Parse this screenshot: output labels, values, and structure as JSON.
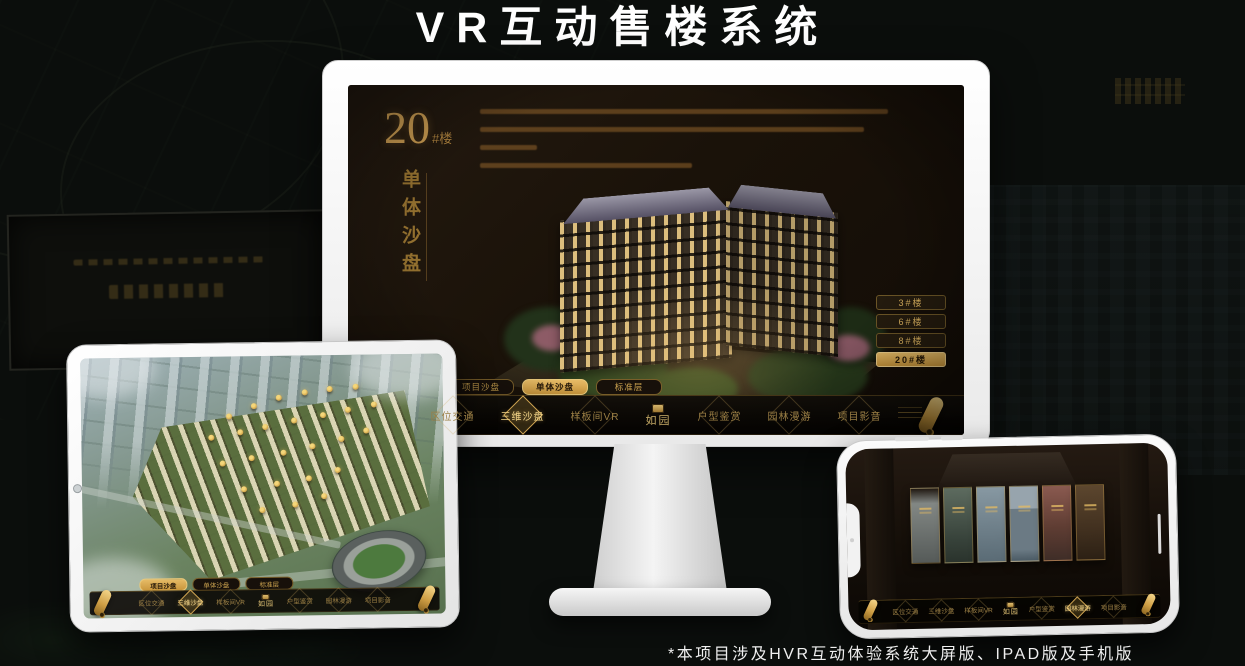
{
  "page": {
    "title": "VR互动售楼系统",
    "footnote": "*本项目涉及HVR互动体验系统大屏版、IPAD版及手机版"
  },
  "colors": {
    "gold": "#d2a855",
    "gold_bright": "#f2d488",
    "screen_background": "#1a1209",
    "selected_tab_fill": "#d8aa55",
    "title_text": "#ffffff"
  },
  "monitor_app": {
    "heading": {
      "number": "20",
      "suffix": "#楼",
      "vertical_label": "单体沙盘"
    },
    "building_buttons": [
      {
        "label": "3#楼",
        "selected": false
      },
      {
        "label": "6#楼",
        "selected": false
      },
      {
        "label": "8#楼",
        "selected": false
      },
      {
        "label": "20#楼",
        "selected": true
      }
    ],
    "sub_tabs": [
      {
        "label": "项目沙盘",
        "selected": false
      },
      {
        "label": "单体沙盘",
        "selected": true
      },
      {
        "label": "标准层",
        "selected": false
      }
    ],
    "nav": {
      "logo": "如园",
      "items": [
        {
          "label": "区位交通",
          "selected": false
        },
        {
          "label": "三维沙盘",
          "selected": true
        },
        {
          "label": "样板间VR",
          "selected": false
        },
        {
          "label": "户型鉴赏",
          "selected": false
        },
        {
          "label": "园林漫游",
          "selected": false
        },
        {
          "label": "项目影音",
          "selected": false
        }
      ]
    }
  },
  "ipad_app": {
    "sub_tabs": [
      {
        "label": "项目沙盘",
        "selected": true
      },
      {
        "label": "单体沙盘",
        "selected": false
      },
      {
        "label": "标准层",
        "selected": false
      }
    ],
    "nav": {
      "logo": "如园",
      "items": [
        {
          "label": "区位交通",
          "selected": false
        },
        {
          "label": "三维沙盘",
          "selected": true
        },
        {
          "label": "样板间VR",
          "selected": false
        },
        {
          "label": "户型鉴赏",
          "selected": false
        },
        {
          "label": "园林漫游",
          "selected": false
        },
        {
          "label": "项目影音",
          "selected": false
        }
      ]
    }
  },
  "phone_app": {
    "nav": {
      "logo": "如园",
      "items": [
        {
          "label": "区位交通",
          "selected": false
        },
        {
          "label": "三维沙盘",
          "selected": false
        },
        {
          "label": "样板间VR",
          "selected": false
        },
        {
          "label": "户型鉴赏",
          "selected": false
        },
        {
          "label": "园林漫游",
          "selected": true
        },
        {
          "label": "项目影音",
          "selected": false
        }
      ]
    },
    "gallery_panel_count": 6
  }
}
